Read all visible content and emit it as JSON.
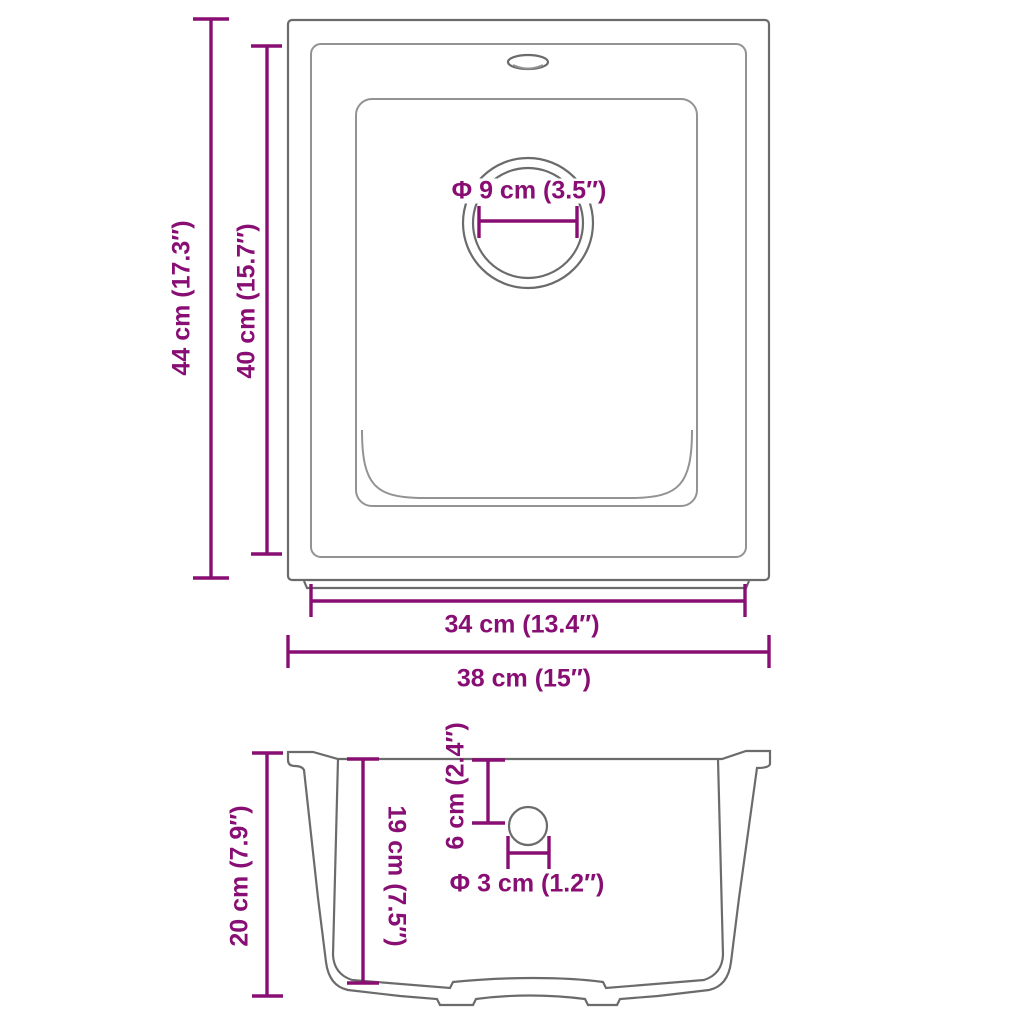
{
  "colors": {
    "dimension": "#880e74",
    "outline_dark": "#6b6b6b",
    "outline_light": "#939393",
    "background": "#ffffff"
  },
  "top_view": {
    "outer_height_label": "44 cm (17.3″)",
    "inner_height_label": "40 cm (15.7″)",
    "drain_diameter_label": "Φ 9 cm (3.5″)",
    "inner_width_label": "34 cm (13.4″)",
    "outer_width_label": "38 cm (15″)"
  },
  "side_view": {
    "height_label": "20 cm (7.9″)",
    "inner_depth_label": "19 cm (7.5″)",
    "drain_offset_label": "6 cm (2.4″)",
    "drain_diameter_label": "Φ 3 cm (1.2″)"
  }
}
